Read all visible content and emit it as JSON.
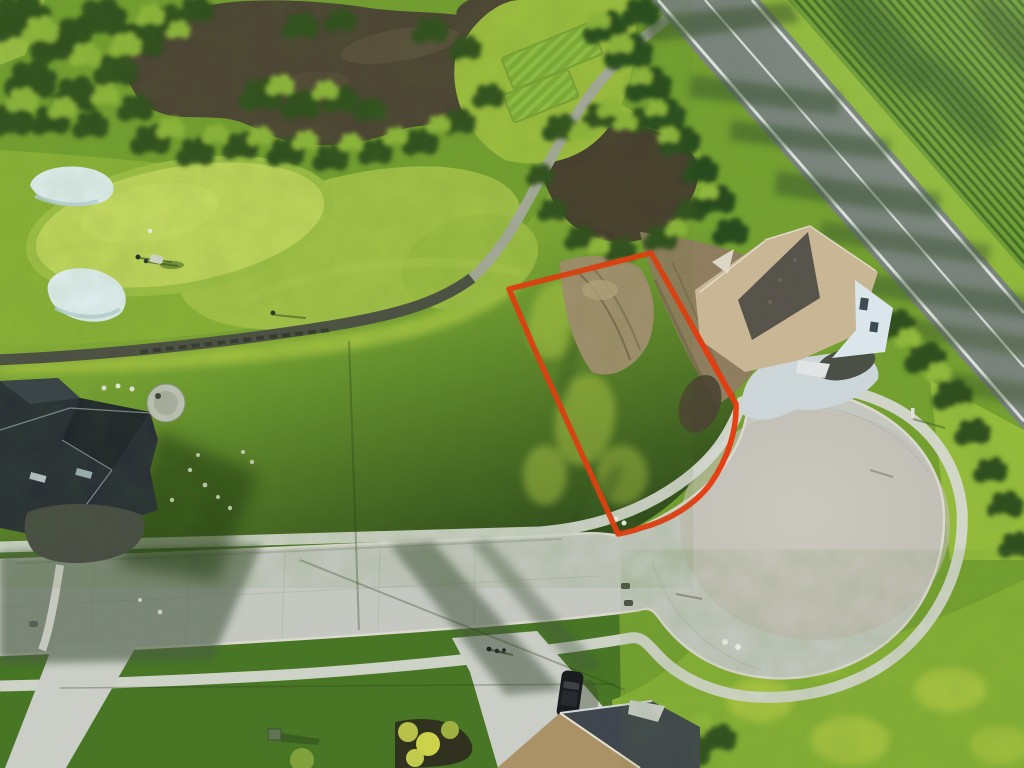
{
  "scene": {
    "type": "aerial-drone-photograph",
    "subject": "Vacant residential building lot outlined in red beside a golf course",
    "setting": "Golf-course community: putting green, sand bunkers and ponds upper left; two-lane rural road and row-crop farm field upper right; concrete cul-de-sac street with new homes below",
    "lighting": "low evening sun from the west casting long shadows to the east"
  },
  "annotations": {
    "lot_outline": {
      "meaning": "property boundary of the vacant lot for sale",
      "shape": "five-sided polygon with curved frontage along the cul-de-sac",
      "color": "#e8380d"
    }
  },
  "objects": {
    "golf_course": {
      "putting_greens": 1,
      "flagsticks": 1,
      "golfers": 2,
      "golf_carts": 1,
      "sand_bunkers": 2,
      "tee_boxes": 2,
      "cart_path": "curves from lower left up to the road"
    },
    "ponds": 3,
    "houses": [
      "two-story home with tan shingle roof and white siding beside the cul-de-sac",
      "dark charcoal-roof home with circular stone patio at lower left",
      "partially visible home at bottom center"
    ],
    "street": {
      "type": "residential concrete street ending in a teardrop cul-de-sac",
      "features": [
        "curbs",
        "grass boulevard",
        "sidewalks both sides",
        "driveway aprons",
        "storm drains",
        "parked dark SUV",
        "pedestrians walking",
        "green utility box",
        "mailbox post"
      ]
    },
    "road": {
      "type": "two-lane rural asphalt road",
      "markings": [
        "white edge lines",
        "white center line"
      ],
      "tree_shadows": "cross the pavement"
    },
    "farm_field": "row-crop field with parallel planting rows"
  },
  "palette": {
    "lot_outline": "#e8380d",
    "grass_base": "#74a02f",
    "grass_sunlit": "#a9c742",
    "grass_shadow": "#2f4c1a",
    "putting_green": "#c1d75c",
    "fairway": "#a3c247",
    "rough": "#8ab236",
    "pond_water": "#4b4134",
    "bunker_sand": "#e3f1f5",
    "cart_path_shade": "#4b4d44",
    "cart_path_sun": "#a8ab9e",
    "road_asphalt": "#79837b",
    "road_marking": "#e7ede9",
    "crop_field_light": "#6d9c33",
    "crop_field_dark": "#426d1f",
    "concrete_street": "#c5c9c2",
    "sidewalk": "#d6d9d2",
    "driveway_right": "#ced7da",
    "roof_tan": "#c9b795",
    "roof_dark_plane": "#56524a",
    "house_wall": "#dce8ee",
    "roof_charcoal": "#262c35",
    "roof_bottom_tan": "#ab9166",
    "roof_bottom_dark": "#3e444c",
    "dirt_light": "#a28f6f",
    "dirt_construction": "#8f7d5e",
    "car_body": "#17191c",
    "shadow_cast": "#2c441c"
  }
}
